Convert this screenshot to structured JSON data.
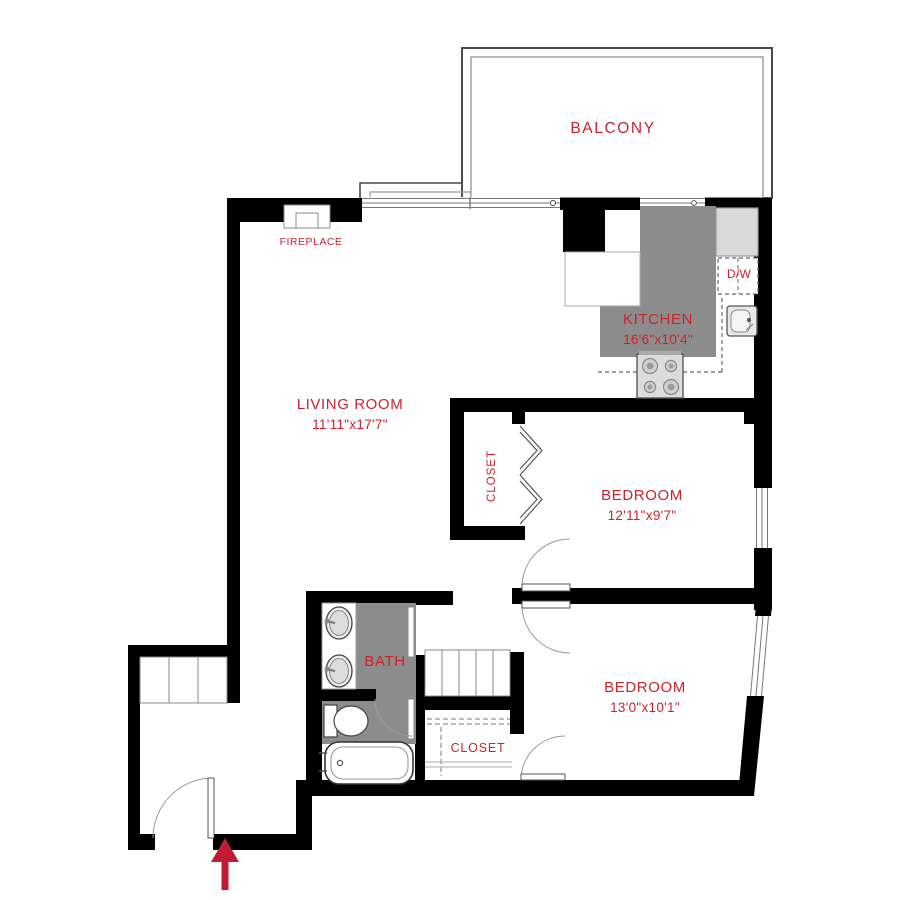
{
  "plan": {
    "title": "apartment-floor-plan",
    "rooms": {
      "balcony": {
        "name": "BALCONY"
      },
      "living_room": {
        "name": "LIVING ROOM",
        "dims": "11'11\"x17'7\""
      },
      "kitchen": {
        "name": "KITCHEN",
        "dims": "16'6\"x10'4\""
      },
      "bedroom_1": {
        "name": "BEDROOM",
        "dims": "12'11\"x9'7\""
      },
      "bedroom_2": {
        "name": "BEDROOM",
        "dims": "13'0\"x10'1\""
      },
      "bath": {
        "name": "BATH"
      },
      "closet_bedroom_1": {
        "name": "CLOSET"
      },
      "closet_bedroom_2": {
        "name": "CLOSET"
      },
      "fireplace": {
        "name": "FIREPLACE"
      },
      "dishwasher": {
        "name": "D/W"
      }
    },
    "fixtures": [
      "fireplace",
      "refrigerator",
      "dishwasher",
      "kitchen-sink",
      "stove",
      "vanity-sinks",
      "toilet",
      "bathtub",
      "linen-shelves",
      "entry-shelves",
      "entry-arrow",
      "bifold-doors",
      "swing-doors",
      "windows",
      "sliding-balcony-door"
    ],
    "colors": {
      "label_red": "#c8232e",
      "arrow_red": "#bf1b32",
      "wall_black": "#000000",
      "floor_gray": "#8c8c8c",
      "appliance_gray": "#d9d9d9",
      "line_gray": "#777777"
    }
  }
}
